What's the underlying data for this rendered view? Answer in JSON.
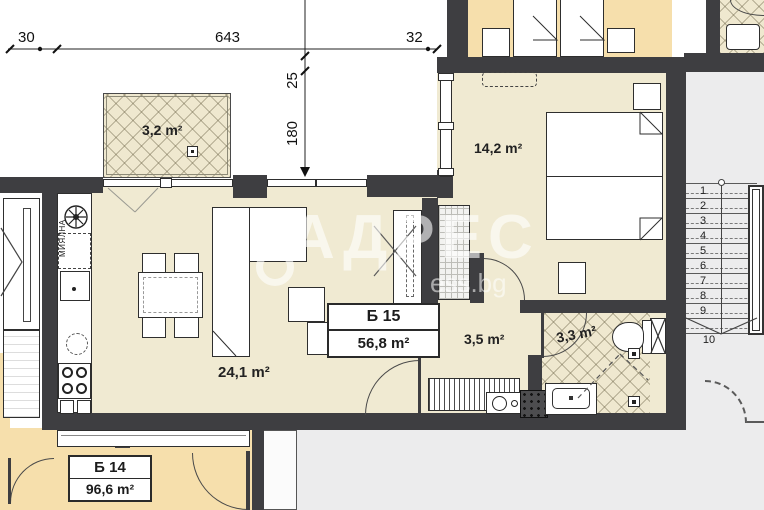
{
  "watermark": {
    "brand": "АДРЕС",
    "site": "ess.bg"
  },
  "dimensions": {
    "left": "30",
    "middle": "643",
    "right": "32",
    "v_small": "25",
    "v_large": "180"
  },
  "rooms": {
    "balcony_area": "3,2 m²",
    "bedroom_area": "14,2 m²",
    "living_area": "24,1 m²",
    "hall_area": "3,5 m²",
    "bath_area": "3,3 m²"
  },
  "units": {
    "b15": {
      "name": "Б 15",
      "area": "56,8 m²"
    },
    "b14": {
      "name": "Б 14",
      "area": "96,6 m²"
    }
  },
  "kitchen": {
    "dishwasher_label": "МИЯЛНА"
  },
  "stairs": {
    "steps": [
      "1",
      "2",
      "3",
      "4",
      "5",
      "6",
      "7",
      "8",
      "9",
      "10"
    ]
  },
  "colors": {
    "wall": "#3e3e41",
    "apartment_floor": "#f0ead2",
    "neighbor_floor": "#f6dfac",
    "background": "#ececed"
  }
}
